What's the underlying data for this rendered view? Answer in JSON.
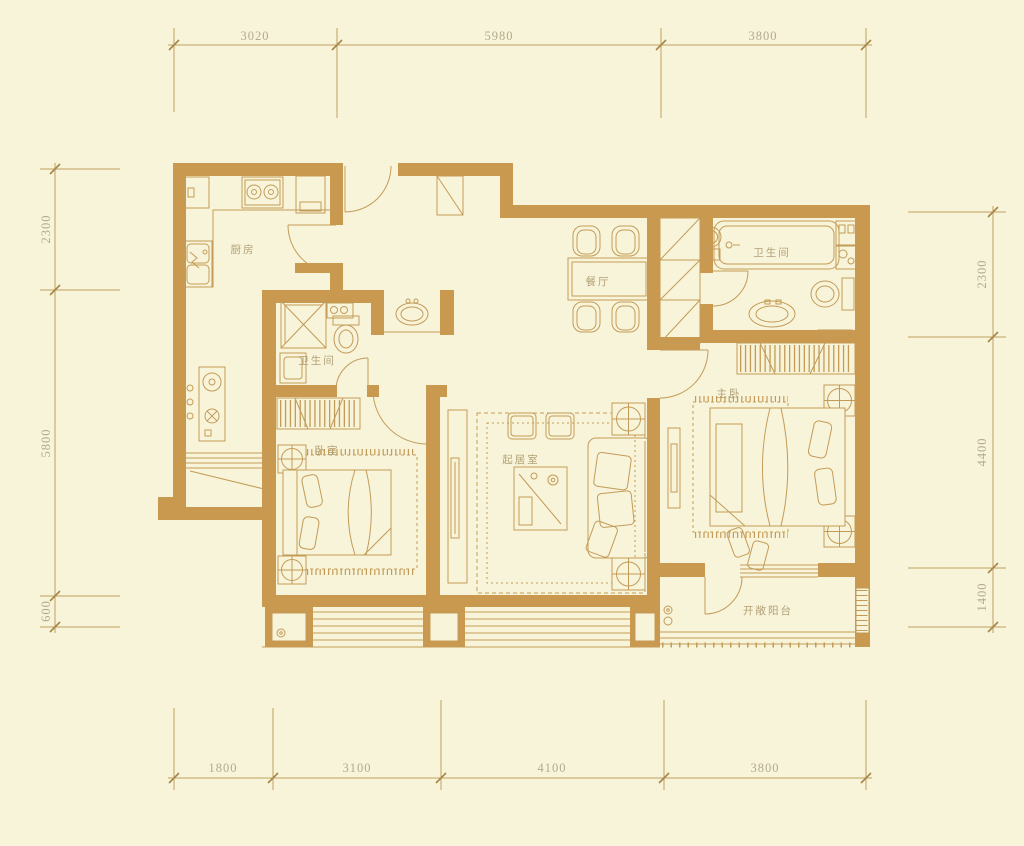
{
  "drawing": {
    "type": "apartment-floor-plan"
  },
  "rooms": {
    "kitchen": {
      "label": "厨房"
    },
    "bath_middle": {
      "label": "卫生间"
    },
    "dining": {
      "label": "餐厅"
    },
    "bath_master": {
      "label": "卫生间"
    },
    "bedroom": {
      "label": "卧室"
    },
    "living": {
      "label": "起居室"
    },
    "master": {
      "label": "主卧"
    },
    "balcony": {
      "label": "开敞阳台"
    }
  },
  "dimensions": {
    "top": [
      "3020",
      "5980",
      "3800"
    ],
    "bottom": [
      "1800",
      "3100",
      "4100",
      "3800"
    ],
    "left": [
      "2300",
      "5800",
      "600"
    ],
    "right": [
      "2300",
      "4400",
      "1400"
    ]
  },
  "colors": {
    "background": "#f8f4d9",
    "wall": "#c8994f",
    "furniture_line": "#c39b58",
    "dimension_line": "#c0a160",
    "dimension_text": "#b3aa8e",
    "room_label_text": "#b2a077"
  }
}
